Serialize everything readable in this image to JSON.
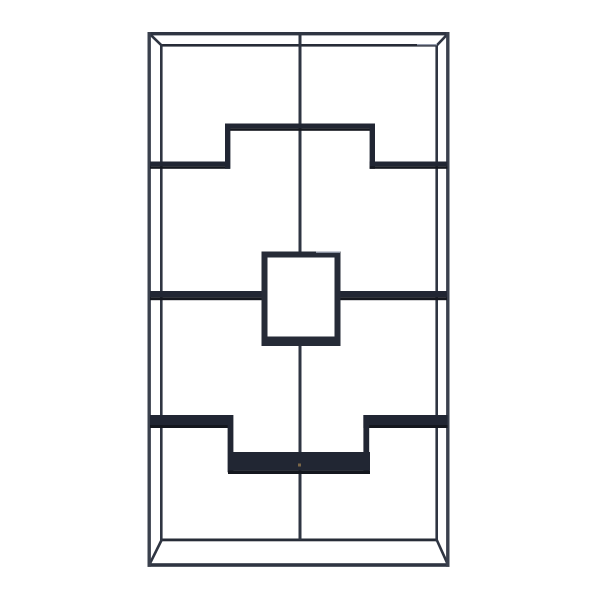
{
  "page": {
    "background_color": "#ffffff",
    "width": 600,
    "height": 600
  },
  "product": {
    "description": "Black metal etagere bookshelf with geometric staggered shelves and a central open display cube, front-view product photo on a white background",
    "colors": {
      "post": "#3a404d",
      "rail": "#2f3542",
      "railDark": "#272c37",
      "shelfTop": "#212633",
      "shelfFace": "#14171e",
      "box": "#262b37",
      "opening": "#ffffff",
      "highlight": "#949bab",
      "brass": "#7a6647"
    },
    "shapes": [
      {
        "name": "top-front-rail",
        "type": "rect",
        "x": 147.5,
        "y": 32,
        "w": 302,
        "h": 3.4,
        "color": "rail"
      },
      {
        "name": "top-back-rail",
        "type": "rect",
        "x": 160,
        "y": 44,
        "w": 278,
        "h": 2.6,
        "color": "railDark"
      },
      {
        "name": "bottom-back-rail",
        "type": "rect",
        "x": 160,
        "y": 538.5,
        "w": 278,
        "h": 2.8,
        "color": "railDark"
      },
      {
        "name": "bottom-front-rail",
        "type": "rect",
        "x": 147.5,
        "y": 563.2,
        "w": 302,
        "h": 3.6,
        "color": "rail"
      },
      {
        "name": "top-left-corner-diagonal",
        "type": "line",
        "x1": 149.3,
        "y1": 33.6,
        "x2": 161.6,
        "y2": 45.4,
        "sw": 2.6,
        "color": "rail"
      },
      {
        "name": "top-right-corner-diagonal",
        "type": "line",
        "x1": 448,
        "y1": 33.6,
        "x2": 436.8,
        "y2": 45.4,
        "sw": 2.6,
        "color": "rail"
      },
      {
        "name": "bottom-left-corner-diagonal",
        "type": "line",
        "x1": 149.3,
        "y1": 564.8,
        "x2": 161.6,
        "y2": 540,
        "sw": 2.6,
        "color": "rail"
      },
      {
        "name": "bottom-right-corner-diagonal",
        "type": "line",
        "x1": 448,
        "y1": 564.8,
        "x2": 436.8,
        "y2": 540,
        "sw": 2.6,
        "color": "rail"
      },
      {
        "name": "front-left-post",
        "type": "rect",
        "x": 147.5,
        "y": 32,
        "w": 3.4,
        "h": 534.8,
        "color": "post"
      },
      {
        "name": "back-left-post",
        "type": "rect",
        "x": 160,
        "y": 44,
        "w": 2.6,
        "h": 497.3,
        "color": "rail"
      },
      {
        "name": "back-right-post",
        "type": "rect",
        "x": 435.4,
        "y": 44,
        "w": 2.6,
        "h": 497.3,
        "color": "rail"
      },
      {
        "name": "front-right-post",
        "type": "rect",
        "x": 446.1,
        "y": 32,
        "w": 3.4,
        "h": 534.8,
        "color": "post"
      },
      {
        "name": "center-post",
        "type": "rect",
        "x": 298.5,
        "y": 34,
        "w": 3,
        "h": 506,
        "color": "rail"
      },
      {
        "name": "top-back-rail-highlight",
        "type": "rect",
        "x": 417,
        "y": 44,
        "w": 20,
        "h": 1.3,
        "color": "highlight"
      },
      {
        "name": "upper-left-shelf-top",
        "type": "rect",
        "x": 150,
        "y": 161.5,
        "w": 80,
        "h": 4.8,
        "color": "shelfTop"
      },
      {
        "name": "upper-left-shelf-face",
        "type": "rect",
        "x": 150,
        "y": 166.3,
        "w": 80,
        "h": 2.5,
        "color": "shelfFace"
      },
      {
        "name": "upper-middle-shelf-top",
        "type": "rect",
        "x": 225,
        "y": 123.5,
        "w": 150,
        "h": 4.8,
        "color": "shelfTop"
      },
      {
        "name": "upper-middle-shelf-face",
        "type": "rect",
        "x": 225,
        "y": 128.3,
        "w": 150,
        "h": 2.5,
        "color": "shelfFace"
      },
      {
        "name": "upper-left-step-bracket",
        "type": "rect",
        "x": 225,
        "y": 123.5,
        "w": 5.4,
        "h": 45.3,
        "color": "shelfTop"
      },
      {
        "name": "upper-right-step-bracket",
        "type": "rect",
        "x": 369.6,
        "y": 123.5,
        "w": 5.4,
        "h": 45.3,
        "color": "shelfTop"
      },
      {
        "name": "upper-right-shelf-top",
        "type": "rect",
        "x": 369.6,
        "y": 161.5,
        "w": 77.8,
        "h": 4.8,
        "color": "shelfTop"
      },
      {
        "name": "upper-right-shelf-face",
        "type": "rect",
        "x": 369.6,
        "y": 166.3,
        "w": 77.8,
        "h": 2.5,
        "color": "shelfFace"
      },
      {
        "name": "middle-left-shelf-top",
        "type": "rect",
        "x": 150,
        "y": 291,
        "w": 113,
        "h": 6.2,
        "color": "shelfTop"
      },
      {
        "name": "middle-left-shelf-face",
        "type": "rect",
        "x": 150,
        "y": 297.2,
        "w": 113,
        "h": 3,
        "color": "shelfFace"
      },
      {
        "name": "middle-right-shelf-top",
        "type": "rect",
        "x": 337,
        "y": 291,
        "w": 110,
        "h": 6.2,
        "color": "shelfTop"
      },
      {
        "name": "middle-right-shelf-face",
        "type": "rect",
        "x": 337,
        "y": 297.2,
        "w": 110,
        "h": 3,
        "color": "shelfFace"
      },
      {
        "name": "display-cube-frame",
        "type": "rect",
        "x": 261.5,
        "y": 251.5,
        "w": 79,
        "h": 94.5,
        "color": "box"
      },
      {
        "name": "display-cube-opening",
        "type": "rect",
        "x": 267.5,
        "y": 257.5,
        "w": 67,
        "h": 79,
        "color": "opening"
      },
      {
        "name": "display-cube-top-highlight",
        "type": "rect",
        "x": 316,
        "y": 251.5,
        "w": 24,
        "h": 1.4,
        "color": "highlight"
      },
      {
        "name": "lower-left-shelf-top",
        "type": "rect",
        "x": 150,
        "y": 415,
        "w": 83,
        "h": 10,
        "color": "shelfTop"
      },
      {
        "name": "lower-left-shelf-face",
        "type": "rect",
        "x": 150,
        "y": 425,
        "w": 83,
        "h": 3,
        "color": "shelfFace"
      },
      {
        "name": "lower-left-step-bracket",
        "type": "rect",
        "x": 227.6,
        "y": 415,
        "w": 5.8,
        "h": 57.3,
        "color": "shelfTop"
      },
      {
        "name": "lower-right-shelf-top",
        "type": "rect",
        "x": 363.4,
        "y": 415,
        "w": 84.2,
        "h": 10,
        "color": "shelfTop"
      },
      {
        "name": "lower-right-shelf-face",
        "type": "rect",
        "x": 363.4,
        "y": 425,
        "w": 84.2,
        "h": 3,
        "color": "shelfFace"
      },
      {
        "name": "lower-right-step-bracket",
        "type": "rect",
        "x": 363.4,
        "y": 415,
        "w": 5.8,
        "h": 58.3,
        "color": "shelfTop"
      },
      {
        "name": "lower-middle-shelf-top",
        "type": "rect",
        "x": 228,
        "y": 452,
        "w": 142,
        "h": 18.6,
        "color": "shelfTop"
      },
      {
        "name": "lower-middle-shelf-face",
        "type": "rect",
        "x": 228,
        "y": 470.6,
        "w": 142,
        "h": 3.4,
        "color": "shelfFace"
      },
      {
        "name": "hardware-screw-detail",
        "type": "rect",
        "x": 298,
        "y": 463.5,
        "w": 3,
        "h": 3,
        "color": "brass"
      }
    ]
  }
}
